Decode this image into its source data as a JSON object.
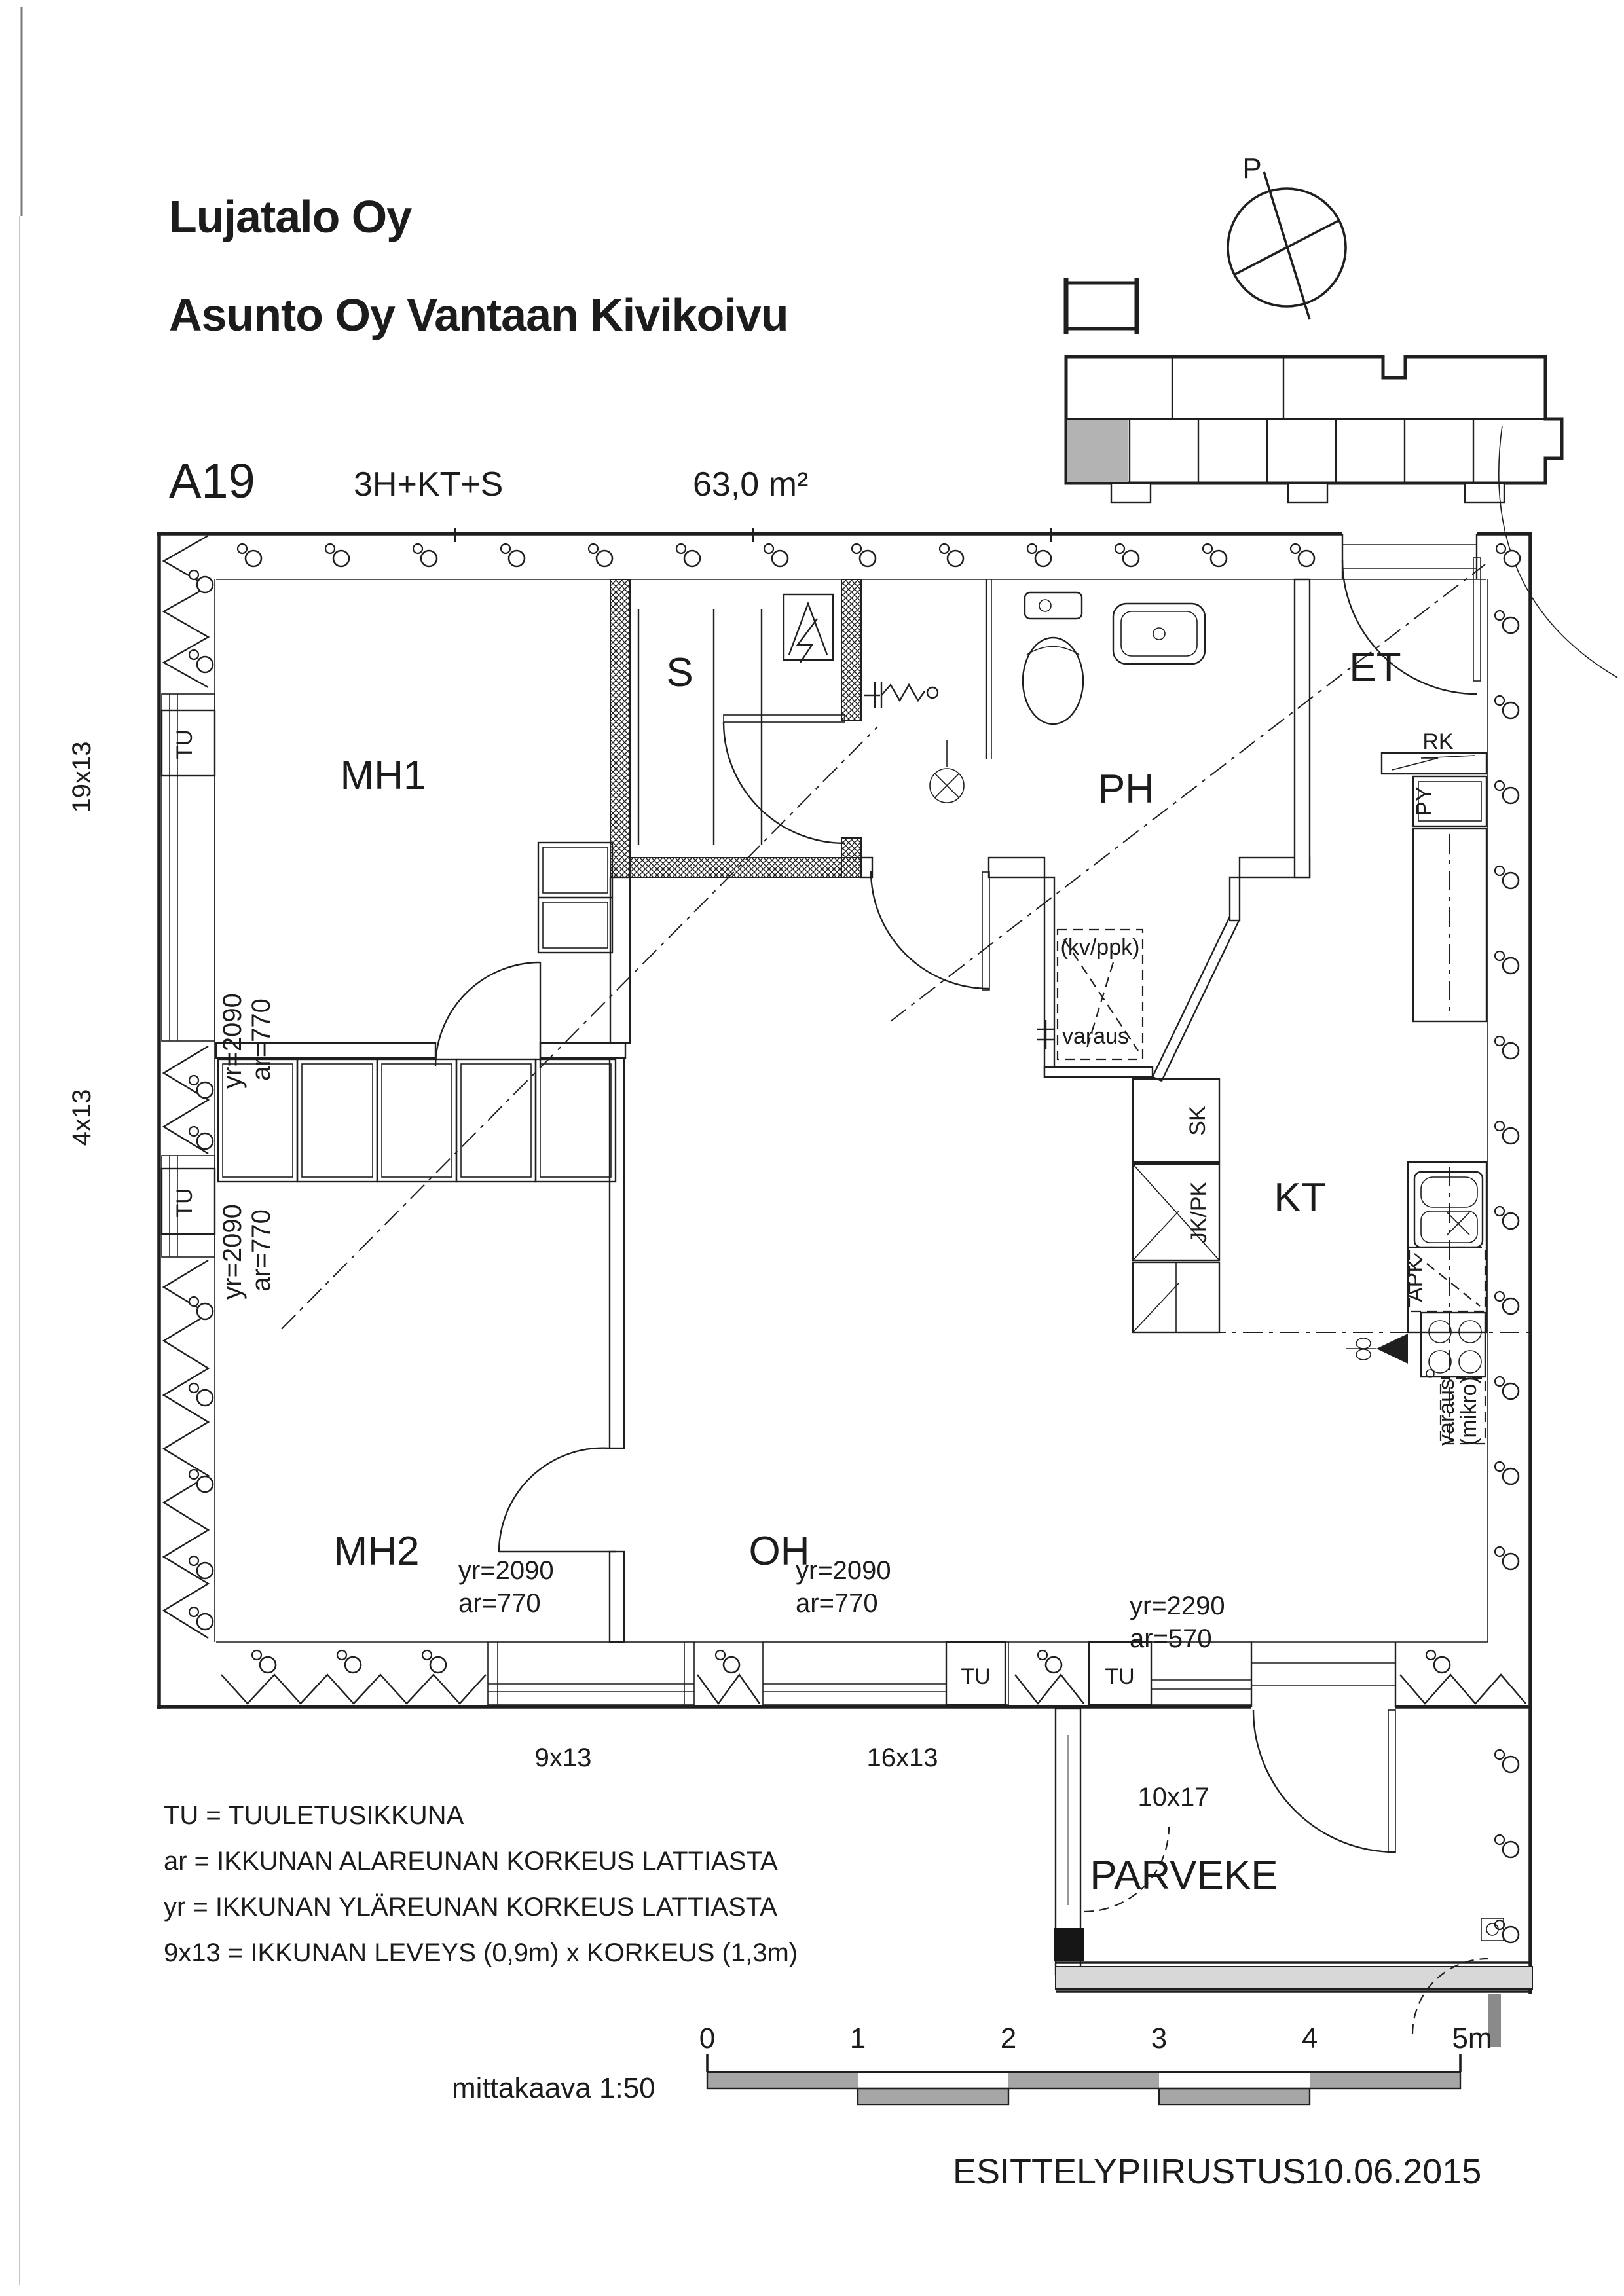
{
  "header": {
    "company": "Lujatalo Oy",
    "project": "Asunto Oy Vantaan Kivikoivu",
    "apartment_id": "A19",
    "apartment_type": "3H+KT+S",
    "area": "63,0 m²",
    "floor": "3. kerros"
  },
  "compass": {
    "label": "P"
  },
  "rooms": {
    "mh1": "MH1",
    "sauna": "S",
    "ph": "PH",
    "et": "ET",
    "kt": "KT",
    "oh": "OH",
    "mh2": "MH2",
    "parveke": "PARVEKE"
  },
  "fixtures": {
    "rk": "RK",
    "py": "PY",
    "sk": "SK",
    "jk_pk": "JK/PK",
    "apk": "APK",
    "kv_ppk": "(kv/ppk)",
    "varaus_ph": "varaus",
    "mikro": "(mikro)",
    "varaus_kt": "varaus"
  },
  "windows": {
    "left_large": {
      "size": "19x13",
      "tu": "TU",
      "yr": "yr=2090",
      "ar": "ar=770"
    },
    "left_small": {
      "size": "4x13",
      "tu": "TU",
      "yr": "yr=2090",
      "ar": "ar=770"
    },
    "bottom_mh2": {
      "size": "9x13",
      "yr": "yr=2090",
      "ar": "ar=770"
    },
    "bottom_oh": {
      "size": "16x13",
      "tu": "TU",
      "yr": "yr=2090",
      "ar": "ar=770"
    },
    "balcony": {
      "size": "10x17",
      "tu": "TU",
      "yr": "yr=2290",
      "ar": "ar=570"
    }
  },
  "legend": {
    "line1": "TU = TUULETUSIKKUNA",
    "line2": "ar = IKKUNAN ALAREUNAN KORKEUS LATTIASTA",
    "line3": "yr = IKKUNAN YLÄREUNAN KORKEUS LATTIASTA",
    "line4": "9x13 = IKKUNAN LEVEYS (0,9m) x KORKEUS (1,3m)"
  },
  "scale_bar": {
    "label": "mittakaava 1:50",
    "ticks": [
      "0",
      "1",
      "2",
      "3",
      "4"
    ],
    "end_label": "5m"
  },
  "footer": {
    "doc_type": "ESITTELYPIIRUSTUS",
    "date": "10.06.2015"
  },
  "colors": {
    "ink": "#1f1f1f",
    "shade": "#b3b3b3",
    "bar_gray": "#a6a6a6"
  }
}
